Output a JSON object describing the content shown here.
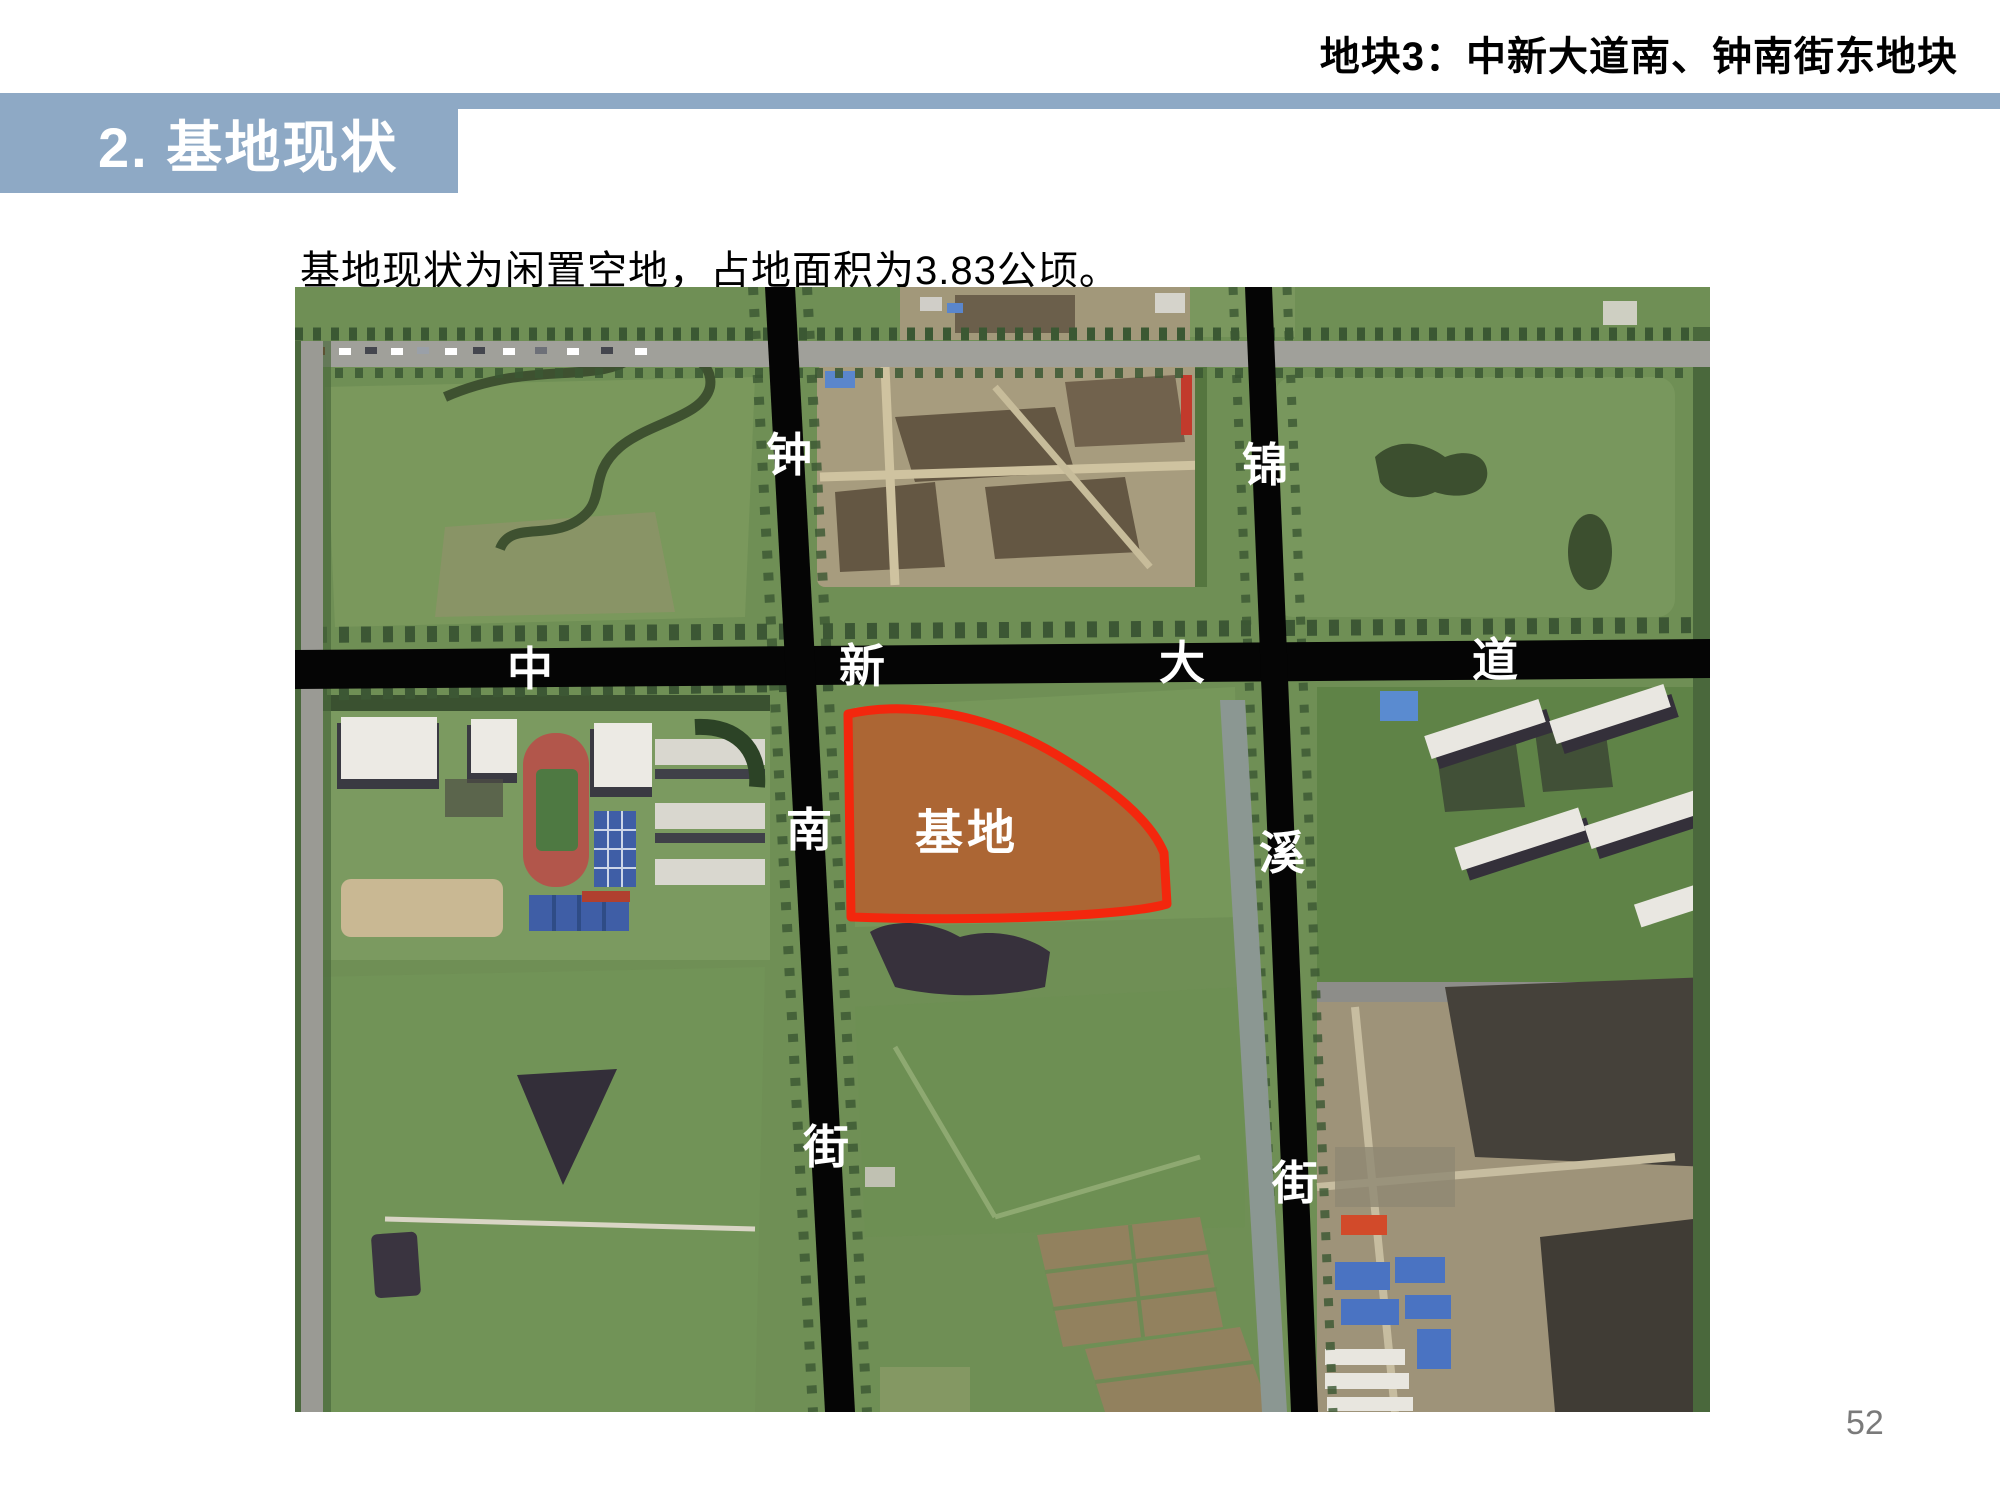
{
  "header": {
    "slide_title": "地块3：中新大道南、钟南街东地块",
    "section_title": "2. 基地现状"
  },
  "body": {
    "description": "基地现状为闲置空地，占地面积为3.83公顷。"
  },
  "map": {
    "site_label": "基地",
    "road_labels": {
      "zhong": "钟",
      "nan": "南",
      "jie_w": "街",
      "jin": "锦",
      "xi": "溪",
      "jie_e": "街",
      "zhong2": "中",
      "xin": "新",
      "da": "大",
      "dao": "道"
    }
  },
  "footer": {
    "page_number": "52"
  },
  "colors": {
    "header_band": "#8EA9C5",
    "section_title_text": "#FFFFFF",
    "road": "#050505",
    "road_label_text": "#FFFFFF",
    "site_outline": "#F3270D",
    "site_fill": "#B85C2C",
    "page_number_text": "#7A7A7A"
  }
}
